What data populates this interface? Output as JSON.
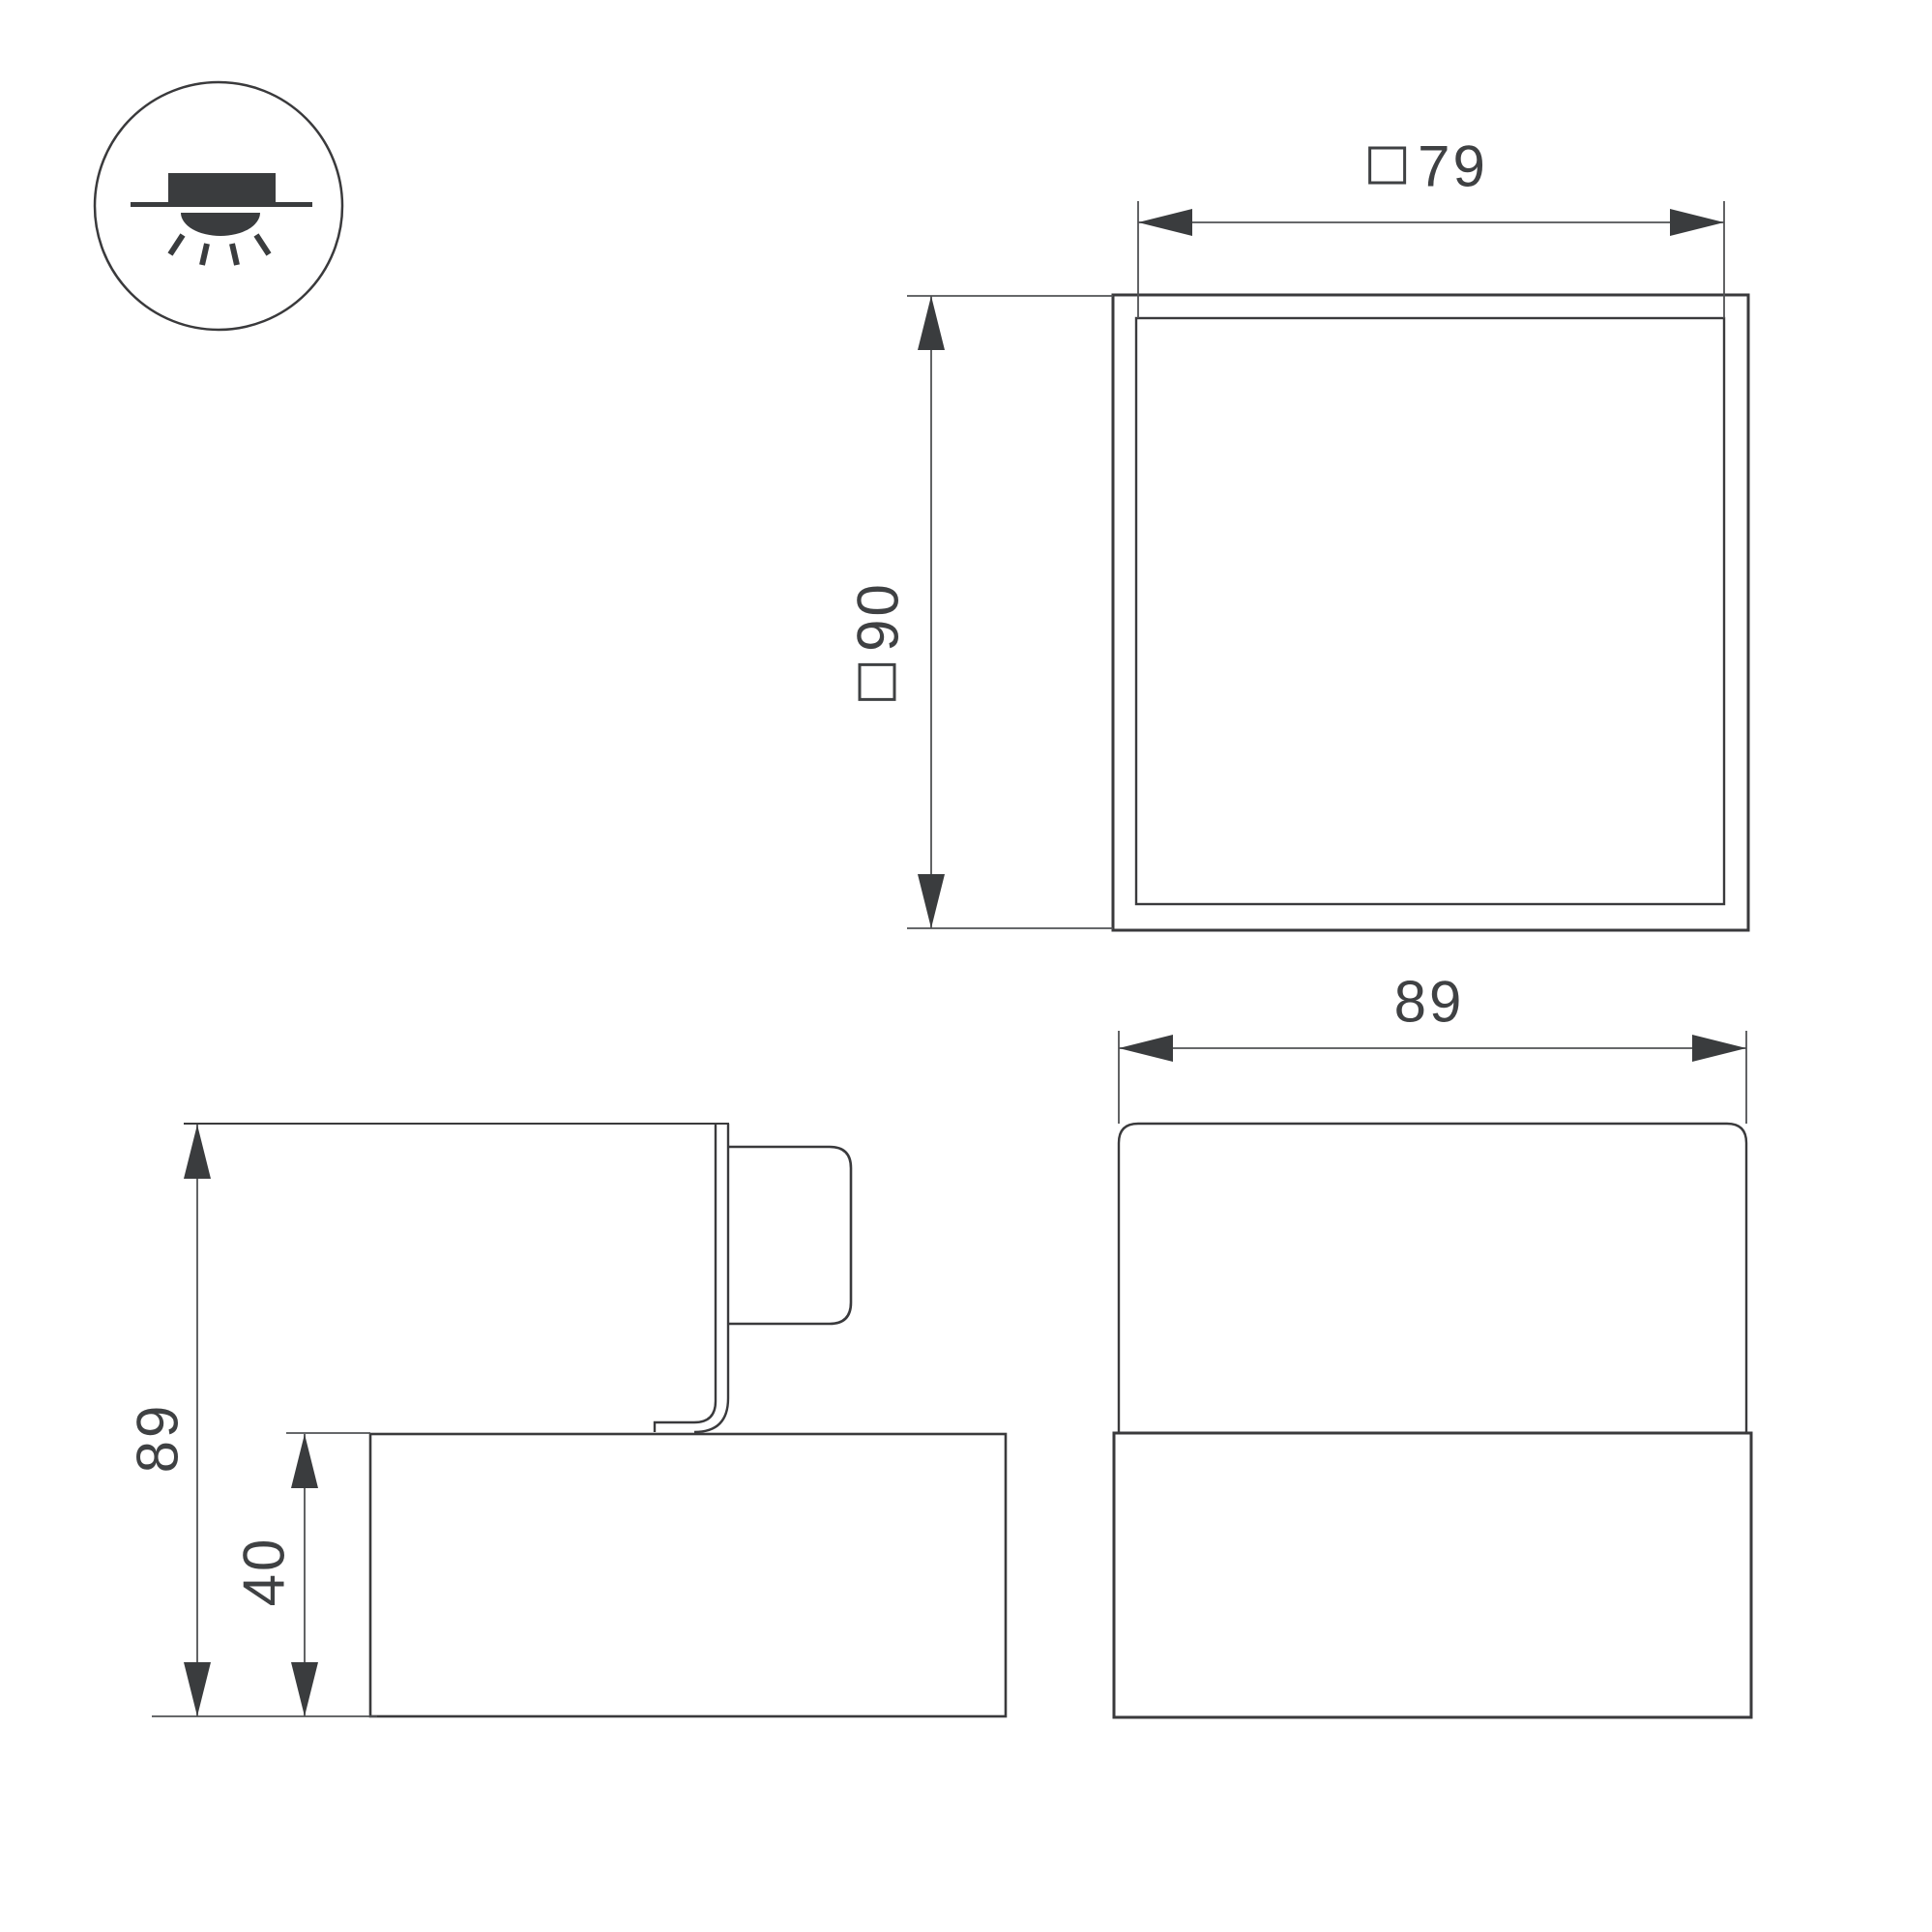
{
  "icon": {
    "name": "recessed-downlight-icon",
    "description": "surface/recessed mounted luminaire symbol"
  },
  "views": {
    "top": {
      "width_dim": {
        "square_prefix": true,
        "value": "79"
      },
      "height_dim": {
        "square_prefix": true,
        "value": "90"
      }
    },
    "side": {
      "overall_height_dim": {
        "square_prefix": false,
        "value": "89"
      },
      "base_height_dim": {
        "square_prefix": false,
        "value": "40"
      }
    },
    "front": {
      "width_dim": {
        "square_prefix": false,
        "value": "89"
      }
    }
  },
  "colors": {
    "object_line": "#3a3a3c",
    "thin_line": "#505254",
    "text": "#3f4143",
    "background": "#ffffff"
  }
}
